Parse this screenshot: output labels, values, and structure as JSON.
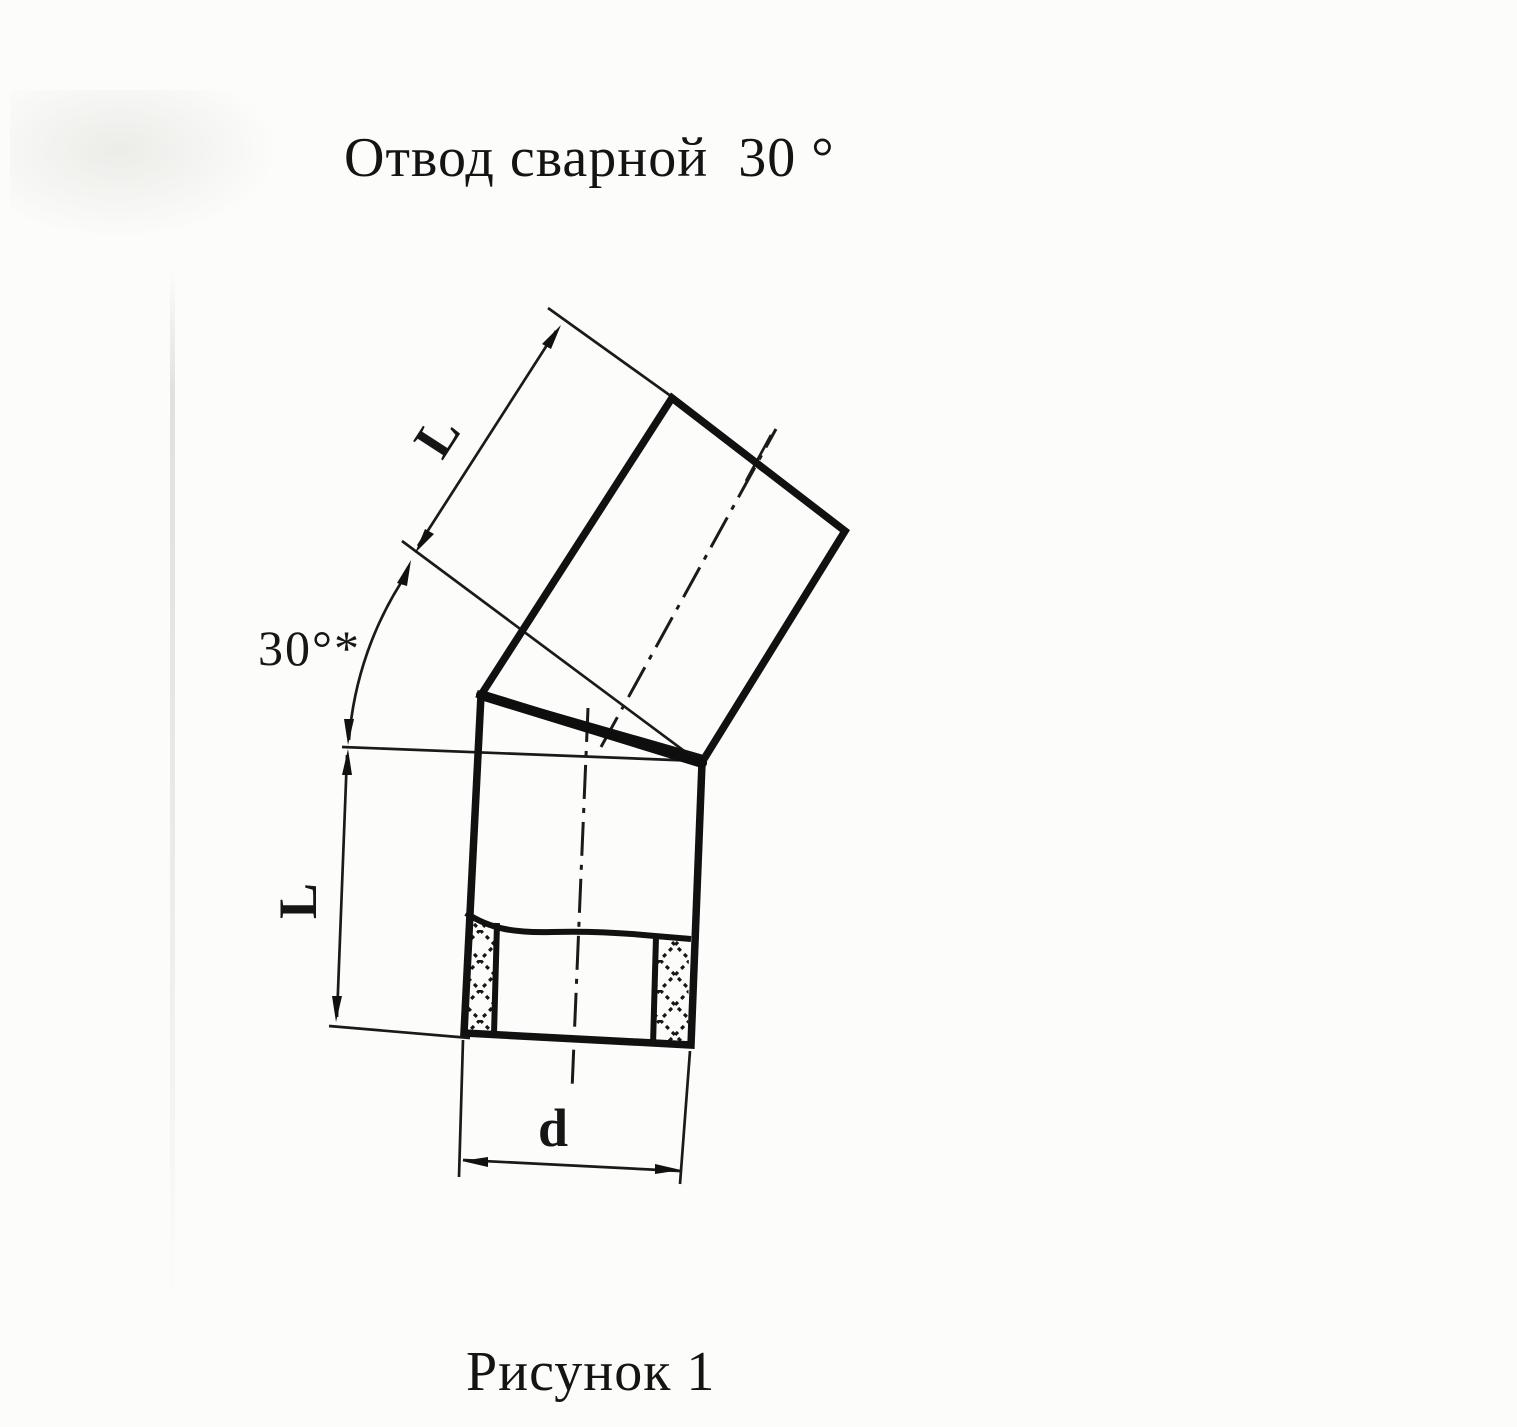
{
  "colors": {
    "ink": "#161616",
    "paper": "#fcfcfa"
  },
  "title": "Отвод сварной  30 °",
  "caption": "Рисунок 1",
  "drawing": {
    "labels": {
      "upper_segment_length": "L",
      "lower_segment_length": "L",
      "bend_angle": "30°*",
      "pipe_diameter": "d"
    }
  }
}
